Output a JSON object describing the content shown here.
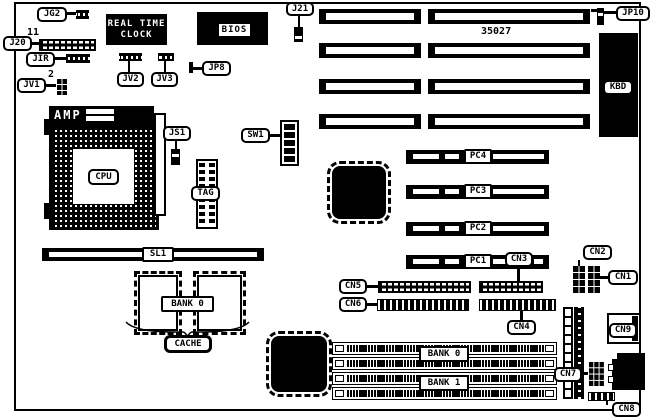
{
  "board": {
    "part_number": "35027",
    "pin_annotations": {
      "j20_first_pin": "11",
      "jv1_first_pin": "2"
    }
  },
  "labels": {
    "jg2": "JG2",
    "j20": "J20",
    "jir": "JIR",
    "jv1": "JV1",
    "jv2": "JV2",
    "jv3": "JV3",
    "jp8": "JP8",
    "j21": "J21",
    "jp10": "JP10",
    "kbd": "KBD",
    "js1": "JS1",
    "sw1": "SW1",
    "cpu": "CPU",
    "tag": "TAG",
    "sl1": "SL1",
    "pc1": "PC1",
    "pc2": "PC2",
    "pc3": "PC3",
    "pc4": "PC4",
    "cn1": "CN1",
    "cn2": "CN2",
    "cn3": "CN3",
    "cn4": "CN4",
    "cn5": "CN5",
    "cn6": "CN6",
    "cn7": "CN7",
    "cn8": "CN8",
    "cn9": "CN9",
    "cache_bank": "BANK 0",
    "cache": "CACHE",
    "simm_bank0": "BANK 0",
    "simm_bank1": "BANK 1"
  },
  "chips": {
    "rtc": {
      "line1": "REAL TIME",
      "line2": "CLOCK"
    },
    "bios": "BIOS",
    "amp": "AMP"
  }
}
